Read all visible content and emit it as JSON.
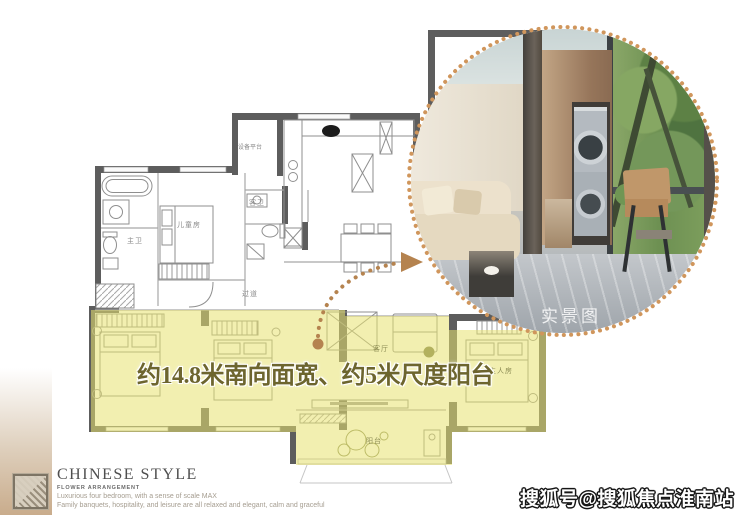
{
  "headline": {
    "text": "约14.8米南向面宽、约5米尺度阳台"
  },
  "photo": {
    "caption": "实景图"
  },
  "floorplan": {
    "labels": {
      "equipment_platform": "设备平台",
      "master_bath": "主卫",
      "kids_room": "儿童房",
      "guest_bath": "客卫",
      "corridor": "过道",
      "living_room": "客厅",
      "master_bedroom": "主人房",
      "balcony": "阳台"
    }
  },
  "branding": {
    "title": "CHINESE STYLE",
    "subtitle": "FLOWER ARRANGEMENT",
    "desc_line1": "Luxurious four bedroom, with a sense of scale MAX",
    "desc_line2": "Family banquets, hospitality, and leisure are all relaxed and elegant, calm and graceful"
  },
  "watermark": {
    "text": "搜狐号@搜狐焦点淮南站"
  },
  "colors": {
    "highlight_yellow": "#e8e170",
    "arrow_accent": "#b5834f",
    "ring_accent": "#d0965c",
    "headline_text": "#6d652e",
    "wall": "#5d5d5d"
  }
}
